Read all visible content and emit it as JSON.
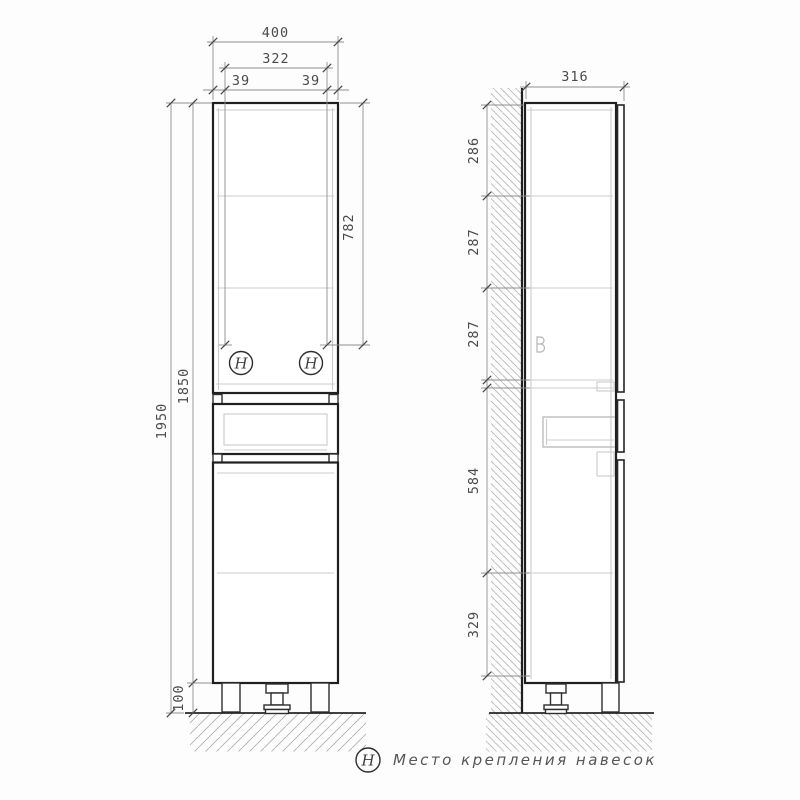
{
  "drawing_type": "cabinet technical drawing, front and side elevation",
  "front_view": {
    "dims": {
      "overall_width": "400",
      "inner_width": "322",
      "hinge_offset_left": "39",
      "hinge_offset_right": "39",
      "overall_height": "1950",
      "cabinet_height": "1850",
      "hinge_from_top": "782",
      "leg_height": "100"
    },
    "hinge_symbol": "H"
  },
  "side_view": {
    "dims": {
      "depth": "316",
      "sections": [
        "286",
        "287",
        "287",
        "584",
        "329"
      ]
    }
  },
  "legend": {
    "symbol": "H",
    "label": "Место крепления навесок"
  },
  "colors": {
    "outline": "#1f1f1f",
    "dimension": "#8e8e8e",
    "shelf_light": "#cbcbcb",
    "hatch": "#b7b7b7",
    "text": "#4a4a4a"
  }
}
